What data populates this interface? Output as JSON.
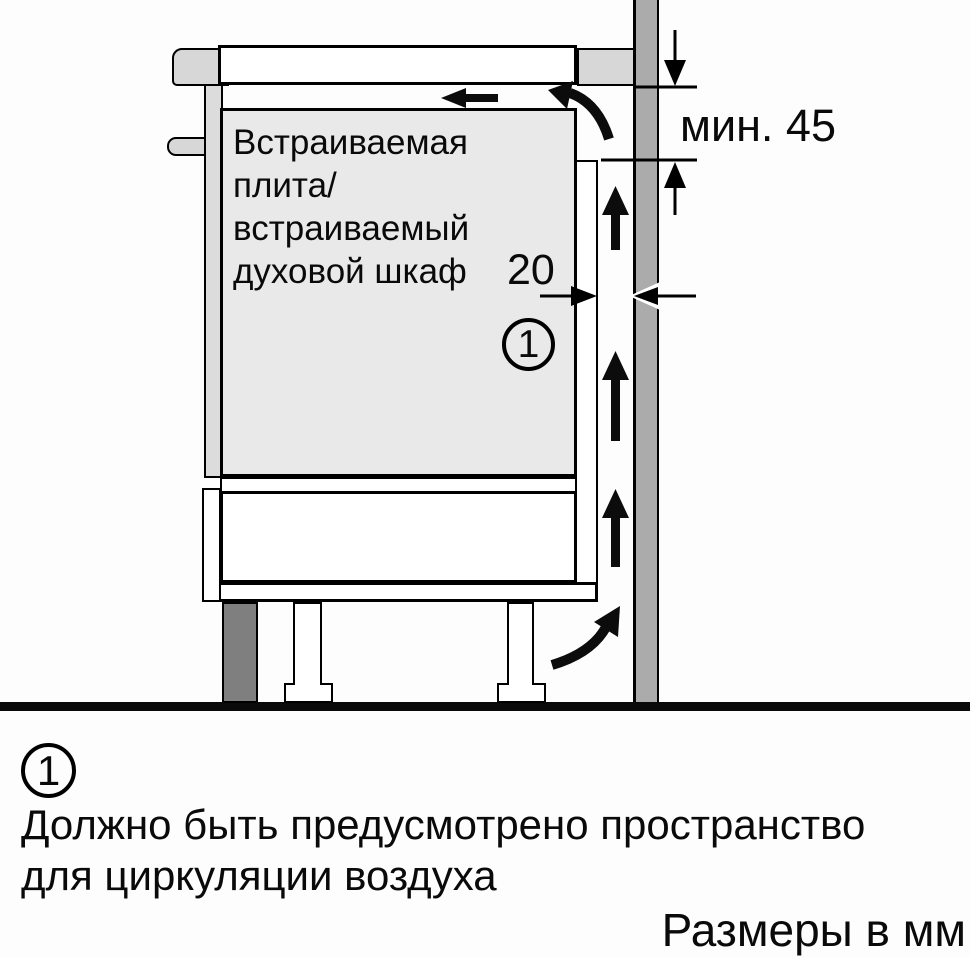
{
  "colors": {
    "background": "#fdfdfd",
    "line": "#000000",
    "panel_light_gray": "#d7d7d7",
    "oven_fill": "#e9e9e9",
    "wall_fill": "#ababab",
    "plinth_dark_gray": "#7f7f7f"
  },
  "diagram": {
    "appliance_label_lines": [
      "Встраиваемая",
      "плита/",
      "встраиваемый",
      "духовой шкаф"
    ],
    "min_clearance_label": "мин. 45",
    "rear_gap_label": "20",
    "callout_number": "1"
  },
  "legend": {
    "callout_number": "1",
    "note_lines": [
      "Должно быть предусмотрено пространство",
      "для циркуляции воздуха"
    ],
    "units_label": "Размеры в мм"
  }
}
